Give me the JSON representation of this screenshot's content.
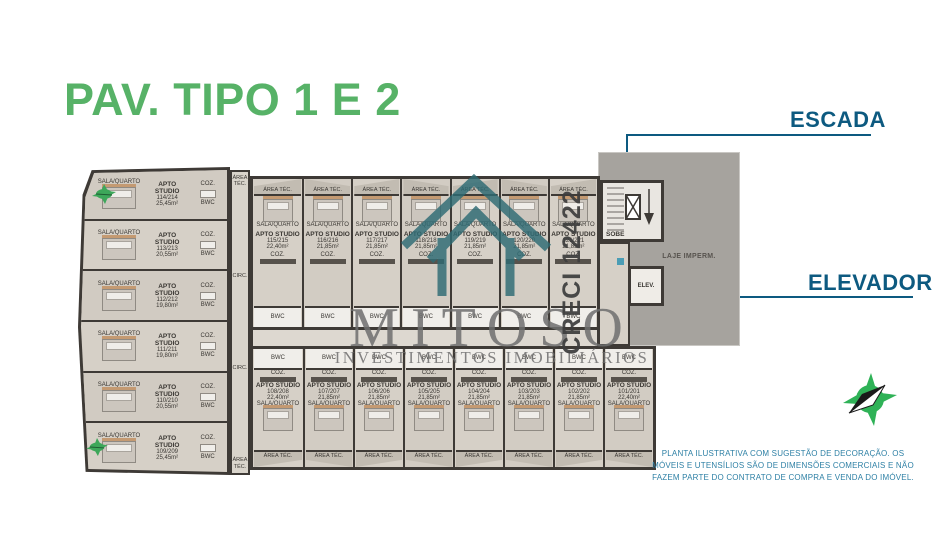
{
  "theme": {
    "green": "#57b267",
    "blue": "#0d5a80",
    "teal": "#2e80a5",
    "graytext": "#6f6f6f",
    "logoteal": "#2e6b74",
    "compassgreen": "#2fb257"
  },
  "page": {
    "title_prefix": "PAV. ",
    "title_main": "TIPO 1 E 2"
  },
  "callouts": {
    "escada": "ESCADA",
    "elevador": "ELEVADOR"
  },
  "watermark": {
    "brand": "MITOSO",
    "tagline": "INVESTIMENTOS IMOBILIÁRIOS",
    "creci": "CRECI 12422"
  },
  "disclaimer": {
    "lines": [
      "PLANTA ILUSTRATIVA COM SUGESTÃO DE DECORAÇÃO. OS",
      "MÓVEIS E UTENSÍLIOS SÃO DE DIMENSÕES COMERCIAIS E NÃO",
      "FAZEM PARTE DO CONTRATO DE COMPRA E VENDA DO IMÓVEL."
    ]
  },
  "plan": {
    "labels": {
      "unit_type": "APTO STUDIO",
      "sala_quarto": "SALA/QUARTO",
      "coz": "COZ.",
      "bwc": "BWC",
      "area_tec": "ÁREA TÉC.",
      "circ": "CIRC.",
      "sobe": "SOBE",
      "elev": "ELEV.",
      "laje": "LAJE IMPERM."
    },
    "left_units": [
      {
        "number": "114/214",
        "area": "25,45m²"
      },
      {
        "number": "113/213",
        "area": "20,55m²"
      },
      {
        "number": "112/212",
        "area": "19,80m²"
      },
      {
        "number": "111/211",
        "area": "19,80m²"
      },
      {
        "number": "110/210",
        "area": "20,55m²"
      },
      {
        "number": "109/209",
        "area": "25,45m²"
      }
    ],
    "top_units": [
      {
        "number": "115/215",
        "area": "22,40m²"
      },
      {
        "number": "116/216",
        "area": "21,85m²"
      },
      {
        "number": "117/217",
        "area": "21,85m²"
      },
      {
        "number": "118/218",
        "area": "21,85m²"
      },
      {
        "number": "119/219",
        "area": "21,85m²"
      },
      {
        "number": "120/220",
        "area": "21,85m²"
      },
      {
        "number": "121/221",
        "area": "21,85m²"
      }
    ],
    "bottom_units": [
      {
        "number": "108/208",
        "area": "22,40m²"
      },
      {
        "number": "107/207",
        "area": "21,85m²"
      },
      {
        "number": "106/206",
        "area": "21,85m²"
      },
      {
        "number": "105/205",
        "area": "21,85m²"
      },
      {
        "number": "104/204",
        "area": "21,85m²"
      },
      {
        "number": "103/203",
        "area": "21,85m²"
      },
      {
        "number": "102/202",
        "area": "21,85m²"
      },
      {
        "number": "101/201",
        "area": "22,40m²"
      }
    ]
  }
}
